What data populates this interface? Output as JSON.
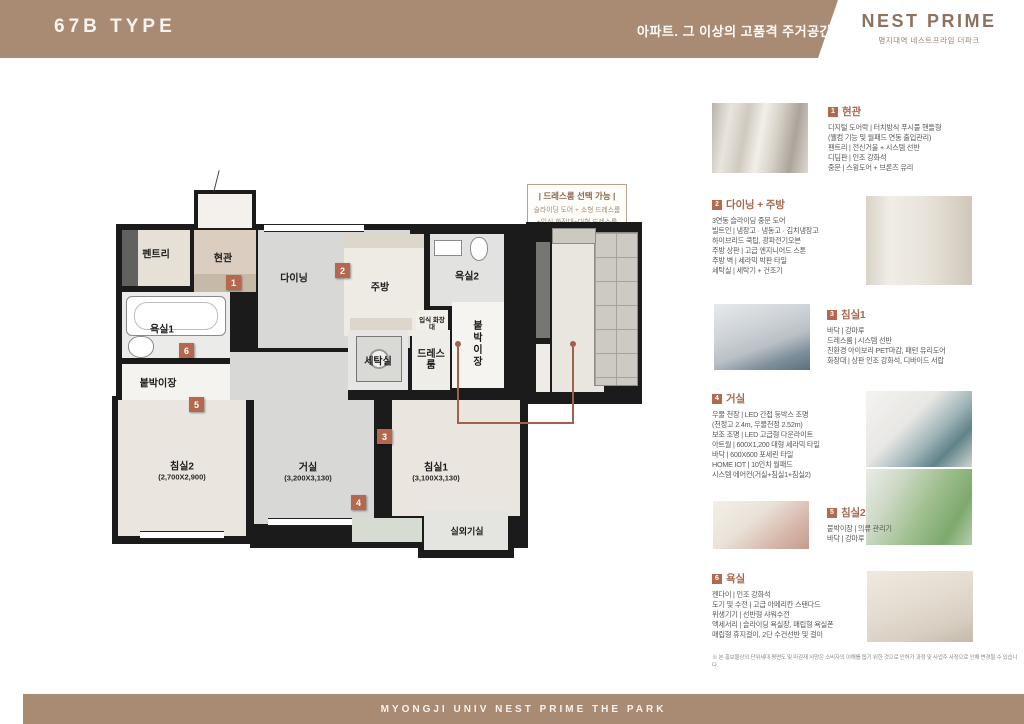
{
  "header": {
    "type_label": "67B TYPE",
    "tagline": "아파트. 그 이상의 고품격 주거공간",
    "brand": "NEST PRIME",
    "brand_sub": "명지대역 네스트프라임 더파크"
  },
  "footer": {
    "text": "MYONGJI UNIV NEST PRIME THE PARK"
  },
  "colors": {
    "header_brown": "#a98a72",
    "marker_terracotta": "#b4694e",
    "logo_brown": "#8d7260"
  },
  "option_note": {
    "title": "| 드레스룸 선택 가능 |",
    "line1": "슬라이딩 도어 + 소형 드레스룸",
    "line2": "+입식 화장대+대형 드레스룸"
  },
  "plan": {
    "markers": [
      "1",
      "2",
      "3",
      "4",
      "5",
      "6"
    ],
    "rooms": {
      "pantry": "펜트리",
      "entrance": "현관",
      "dining": "다이닝",
      "kitchen": "주방",
      "bath2": "욕실2",
      "vanity": "입식 화장대",
      "laundry": "세탁실",
      "dressroom": "드레스룸",
      "closet_right": "붙박이장",
      "bath1": "욕실1",
      "closet_left": "붙박이장",
      "bed2": "침실2",
      "bed2_size": "(2,700X2,900)",
      "living": "거실",
      "living_size": "(3,200X3,130)",
      "bed1": "침실1",
      "bed1_size": "(3,100X3,130)",
      "outdoor": "실외기실"
    }
  },
  "sections": [
    {
      "num": "1",
      "title": "현관",
      "lines": [
        "디지털 도어락 | 터치방식 푸시풀 핸들형",
        "(웰컴 기능 및 월패드 연동 출입관리)",
        "팬트리 | 전신거울 + 시스템 선반",
        "디딤판 | 인조 강화석",
        "중문 | 스윙도어 + 브론즈 유리"
      ]
    },
    {
      "num": "2",
      "title": "다이닝 + 주방",
      "lines": [
        "3연동 슬라이딩 중문 도어",
        "빌트인 | 냉장고 · 냉동고 · 김치냉장고",
        "하이브리드 쿡탑, 광파전기오븐",
        "주방 상판 | 고급 엔지니어드 스톤",
        "주방 벽 | 세라믹 박판 타일",
        "세탁실 | 세탁기 + 건조기"
      ]
    },
    {
      "num": "3",
      "title": "침실1",
      "lines": [
        "바닥 | 강마루",
        "드레스룸 | 시스템 선반",
        "친환경 아이보리 PET마감, 패턴 유리도어",
        "화장대 | 상판 인조 강화석, 디바이드 서랍"
      ]
    },
    {
      "num": "4",
      "title": "거실",
      "lines": [
        "우물 천장 | LED 간접 등박스 조명",
        "(천정고 2.4m, 우물천정 2.52m)",
        "보조 조명 | LED 고급형 다운라이트",
        "아트월 | 600X1,200 대형 세라믹 타일",
        "바닥 | 600X600 포세린 타일",
        "HOME IOT | 10인치 월패드",
        "시스템 에어컨(거실+침실1+침실2)"
      ]
    },
    {
      "num": "5",
      "title": "침실2",
      "lines": [
        "붙박이장 | 의류 관리기",
        "바닥 | 강마루"
      ]
    },
    {
      "num": "6",
      "title": "욕실",
      "lines": [
        "젠다이 | 인조 강화석",
        "도기 및 수전 | 고급 아메리칸 스탠다드",
        "위생기기 | 선반형 샤워수전",
        "액세서리 | 슬라이딩 욕실장, 매립형 욕실폰",
        "매립형 휴지걸이, 2단 수건선반 및 걸이"
      ]
    }
  ],
  "disclaimer": "※ 본 홍보물상의 단위세대 평면도 및 마감재 사양은 소비자의 이해를 돕기 위한 것으로 인허가 과정 및 사업주 사정으로 인해 변경될 수 있습니다."
}
